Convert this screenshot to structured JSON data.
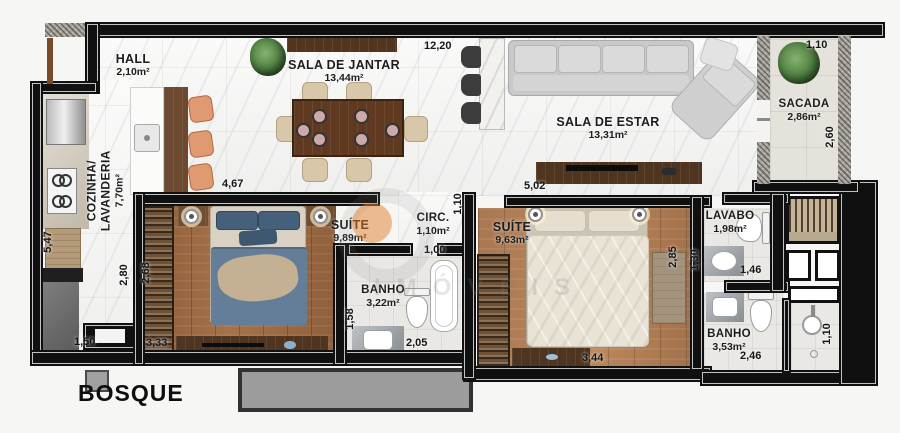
{
  "plan_title": "BOSQUE",
  "watermark_text": "IMÓVEIS",
  "rooms": {
    "hall": {
      "name": "HALL",
      "area": "2,10m²"
    },
    "sala_de_jantar": {
      "name": "SALA DE JANTAR",
      "area": "13,44m²"
    },
    "sala_de_estar": {
      "name": "SALA DE ESTAR",
      "area": "13,31m²"
    },
    "sacada": {
      "name": "SACADA",
      "area": "2,86m²"
    },
    "cozinha": {
      "name": "COZINHA/",
      "name2": "LAVANDERIA",
      "area": "7,70m²"
    },
    "suite1": {
      "name": "SUÍTE",
      "area": "9,89m²"
    },
    "circ": {
      "name": "CIRC.",
      "area": "1,10m²"
    },
    "banho1": {
      "name": "BANHO",
      "area": "3,22m²"
    },
    "suite2": {
      "name": "SUÍTE",
      "area": "9,63m²"
    },
    "lavabo": {
      "name": "LAVABO",
      "area": "1,98m²"
    },
    "banho2": {
      "name": "BANHO",
      "area": "3,53m²"
    }
  },
  "dimensions": {
    "living_top_width": "12,20",
    "sacada_width": "1,10",
    "sacada_depth": "2,60",
    "kitchen_height": "5,47",
    "kitchen_inner_height": "2,80",
    "kitchen_bottom": "1,50",
    "suite1_top_width": "4,67",
    "suite1_depth": "2,68",
    "suite1_bottom": "3,33",
    "banho1_depth": "1,58",
    "banho1_bottom": "2,05",
    "circ_width": "1,00",
    "circ_depth": "1,10",
    "suite2_top_width": "5,02",
    "suite2_depth": "2,85",
    "suite2_bottom": "3,44",
    "lavabo_depth": "1,30",
    "lavabo_bottom": "1,46",
    "banho2_bottom": "2,46",
    "shower_depth": "1,10"
  },
  "colors": {
    "wall": "#101010",
    "wood-floor": "#96653f",
    "marble-floor": "#f5f5f4",
    "accent-orange": "#e07e2d",
    "plan-bg": "#f6f6f4"
  }
}
